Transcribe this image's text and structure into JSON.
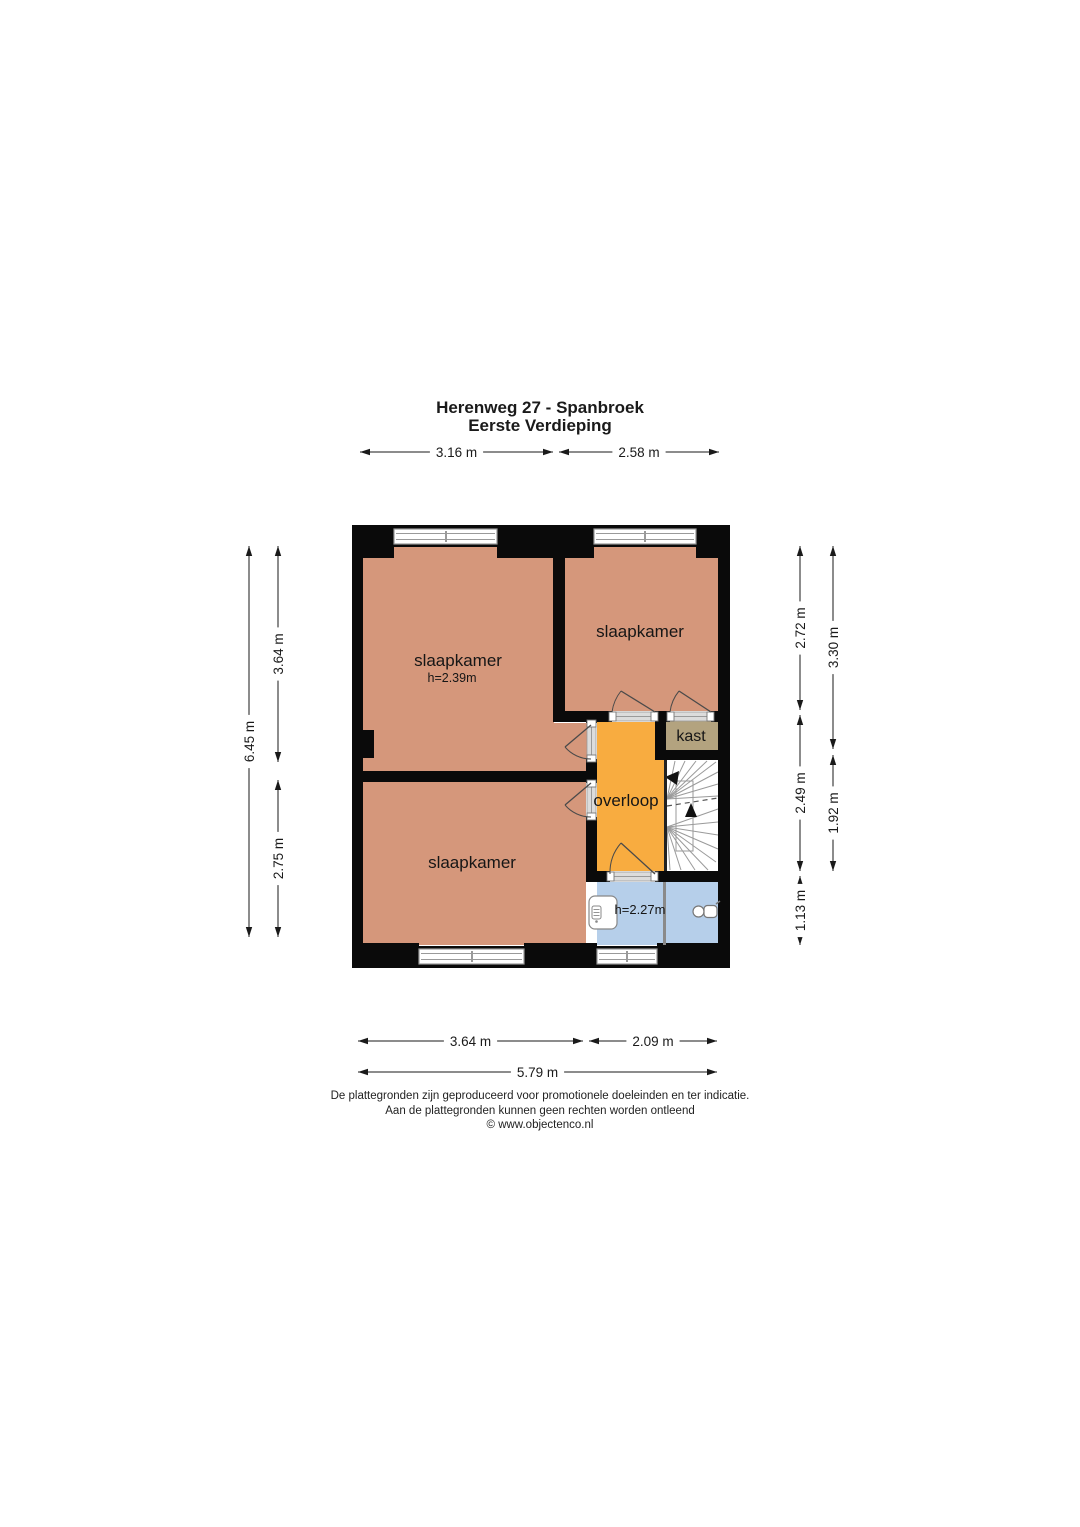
{
  "title": {
    "line1": "Herenweg 27 - Spanbroek",
    "line2": "Eerste Verdieping"
  },
  "footer": {
    "line1": "De plattegronden zijn geproduceerd voor promotionele doeleinden en ter indicatie.",
    "line2": "Aan de plattegronden kunnen geen rechten worden ontleend",
    "line3": "© www.objectenco.nl"
  },
  "colors": {
    "wall": "#0a0a0a",
    "bedroom": "#d5977b",
    "landing": "#f8ac40",
    "closet": "#b3a37f",
    "bathroom": "#b6cfea",
    "stairs": "#ffffff",
    "frame": "#9a9a9a",
    "door": "#4a4a4a",
    "dim": "#1a1a1a"
  },
  "plan": {
    "rooms": [
      {
        "name": "room-bedroom-top-left",
        "color": "bedroom",
        "rects": [
          [
            362,
            547,
            192,
            226
          ],
          [
            554,
            723,
            33,
            50
          ]
        ]
      },
      {
        "name": "room-bedroom-top-right",
        "color": "bedroom",
        "rects": [
          [
            565,
            547,
            153,
            164
          ]
        ]
      },
      {
        "name": "room-bedroom-bottom",
        "color": "bedroom",
        "rects": [
          [
            362,
            782,
            224,
            163
          ]
        ]
      },
      {
        "name": "room-overloop",
        "color": "landing",
        "rects": [
          [
            597,
            722,
            67,
            149
          ]
        ]
      },
      {
        "name": "room-kast",
        "color": "closet",
        "rects": [
          [
            666,
            720,
            52,
            30
          ]
        ]
      },
      {
        "name": "room-bathroom",
        "color": "bathroom",
        "rects": [
          [
            597,
            882,
            121,
            63
          ]
        ]
      }
    ],
    "walls": [
      [
        352,
        525,
        11,
        443
      ],
      [
        718,
        525,
        12,
        443
      ],
      [
        352,
        525,
        378,
        22
      ],
      [
        352,
        525,
        42,
        33
      ],
      [
        497,
        525,
        97,
        33
      ],
      [
        696,
        525,
        34,
        33
      ],
      [
        352,
        946,
        378,
        22
      ],
      [
        352,
        943,
        67,
        25
      ],
      [
        524,
        943,
        73,
        25
      ],
      [
        657,
        943,
        73,
        25
      ],
      [
        553,
        547,
        12,
        175
      ],
      [
        553,
        711,
        59,
        11
      ],
      [
        655,
        711,
        15,
        11
      ],
      [
        711,
        711,
        7,
        11
      ],
      [
        655,
        711,
        11,
        49
      ],
      [
        655,
        750,
        63,
        10
      ],
      [
        586,
        715,
        11,
        8
      ],
      [
        586,
        759,
        11,
        24
      ],
      [
        586,
        817,
        11,
        57
      ],
      [
        352,
        771,
        238,
        11
      ],
      [
        586,
        871,
        24,
        11
      ],
      [
        655,
        871,
        63,
        11
      ],
      [
        352,
        730,
        22,
        28
      ]
    ],
    "windows": [
      {
        "x": 394,
        "y": 529,
        "w": 103,
        "h": 15,
        "tick": 446
      },
      {
        "x": 594,
        "y": 529,
        "w": 102,
        "h": 15,
        "tick": 645
      },
      {
        "x": 419,
        "y": 949,
        "w": 105,
        "h": 15,
        "tick": 472
      },
      {
        "x": 597,
        "y": 949,
        "w": 60,
        "h": 15,
        "tick": 627
      }
    ],
    "thresholds": [
      {
        "x": 612,
        "y": 712,
        "w": 43,
        "h": 9,
        "dir": "h"
      },
      {
        "x": 670,
        "y": 712,
        "w": 41,
        "h": 9,
        "dir": "h"
      },
      {
        "x": 587,
        "y": 723,
        "w": 9,
        "h": 36,
        "dir": "v"
      },
      {
        "x": 587,
        "y": 783,
        "w": 9,
        "h": 34,
        "dir": "v"
      },
      {
        "x": 610,
        "y": 872,
        "w": 45,
        "h": 9,
        "dir": "h"
      }
    ],
    "doors": [
      {
        "name": "door-bedroom-top-right",
        "hinge": [
          655,
          712
        ],
        "jamb": [
          612,
          712
        ],
        "tip": [
          621,
          691
        ]
      },
      {
        "name": "door-kast",
        "hinge": [
          711,
          712
        ],
        "jamb": [
          670,
          712
        ],
        "tip": [
          679,
          691
        ]
      },
      {
        "name": "door-bedroom-top-left",
        "hinge": [
          591,
          725
        ],
        "jamb": [
          591,
          759
        ],
        "tip": [
          565,
          747
        ]
      },
      {
        "name": "door-bedroom-bottom",
        "hinge": [
          591,
          783
        ],
        "jamb": [
          591,
          817
        ],
        "tip": [
          565,
          805
        ]
      },
      {
        "name": "door-bathroom",
        "hinge": [
          655,
          874
        ],
        "jamb": [
          610,
          874
        ],
        "tip": [
          621,
          843
        ]
      }
    ],
    "stairs": {
      "area": [
        667,
        760,
        51,
        111
      ],
      "well": [
        676,
        781,
        17,
        70
      ],
      "divider": [
        664,
        760,
        3,
        111
      ],
      "upper_hub": [
        667,
        799
      ],
      "upper_ends": [
        [
          675,
          761
        ],
        [
          685,
          761
        ],
        [
          696,
          761
        ],
        [
          707,
          761
        ],
        [
          716,
          762
        ],
        [
          718,
          772
        ],
        [
          718,
          784
        ],
        [
          718,
          796
        ]
      ],
      "lower_hub": [
        667,
        827
      ],
      "lower_ends": [
        [
          718,
          809
        ],
        [
          718,
          822
        ],
        [
          718,
          835
        ],
        [
          718,
          849
        ],
        [
          716,
          862
        ],
        [
          708,
          870
        ],
        [
          695,
          870
        ],
        [
          681,
          870
        ],
        [
          670,
          870
        ]
      ],
      "dashed": [
        667,
        806,
        718,
        798
      ],
      "arrow_left": [
        [
          665,
          777
        ],
        [
          679,
          771
        ],
        [
          677,
          785
        ]
      ],
      "arrow_up": [
        [
          691,
          803
        ],
        [
          685,
          817
        ],
        [
          697,
          817
        ]
      ]
    },
    "fixtures": {
      "bath_divider": [
        663,
        882,
        3,
        63
      ],
      "shower": {
        "x": 589,
        "y": 896,
        "w": 28,
        "h": 33,
        "panel": [
          592,
          906,
          9,
          13
        ],
        "dot": [
          596.5,
          921.5
        ]
      },
      "toilet": {
        "bowl": [
          698.5,
          911.5,
          5.5
        ],
        "tank": [
          704,
          905.5,
          13,
          12
        ],
        "spout": [
          716,
          904,
          720,
          901
        ]
      }
    },
    "labels": [
      {
        "name": "label-bedroom-top-left",
        "text": "slaapkamer",
        "x": 458,
        "y": 666,
        "size": 17
      },
      {
        "name": "label-bedroom-top-left-height",
        "text": "h=2.39m",
        "x": 452,
        "y": 682,
        "size": 12.5
      },
      {
        "name": "label-bedroom-top-right",
        "text": "slaapkamer",
        "x": 640,
        "y": 637,
        "size": 17
      },
      {
        "name": "label-kast",
        "text": "kast",
        "x": 691,
        "y": 741,
        "size": 16
      },
      {
        "name": "label-overloop",
        "text": "overloop",
        "x": 626,
        "y": 806,
        "size": 17
      },
      {
        "name": "label-bedroom-bottom",
        "text": "slaapkamer",
        "x": 472,
        "y": 868,
        "size": 17
      },
      {
        "name": "label-bathroom-height",
        "text": "h=2.27m",
        "x": 640,
        "y": 914,
        "size": 13
      }
    ],
    "dimensions": {
      "horizontal": [
        {
          "y": 452,
          "x1": 360,
          "x2": 553,
          "label": "3.16 m"
        },
        {
          "y": 452,
          "x1": 559,
          "x2": 719,
          "label": "2.58 m"
        },
        {
          "y": 1041,
          "x1": 358,
          "x2": 583,
          "label": "3.64 m"
        },
        {
          "y": 1041,
          "x1": 589,
          "x2": 717,
          "label": "2.09 m"
        },
        {
          "y": 1072,
          "x1": 358,
          "x2": 717,
          "label": "5.79 m"
        }
      ],
      "vertical": [
        {
          "x": 249,
          "y1": 546,
          "y2": 937,
          "label": "6.45 m"
        },
        {
          "x": 278,
          "y1": 546,
          "y2": 762,
          "label": "3.64 m"
        },
        {
          "x": 278,
          "y1": 780,
          "y2": 937,
          "label": "2.75 m"
        },
        {
          "x": 800,
          "y1": 546,
          "y2": 710,
          "label": "2.72 m"
        },
        {
          "x": 800,
          "y1": 715,
          "y2": 871,
          "label": "2.49 m"
        },
        {
          "x": 800,
          "y1": 876,
          "y2": 945,
          "label": "1.13 m"
        },
        {
          "x": 833,
          "y1": 546,
          "y2": 749,
          "label": "3.30 m"
        },
        {
          "x": 833,
          "y1": 755,
          "y2": 871,
          "label": "1.92 m"
        }
      ]
    }
  }
}
